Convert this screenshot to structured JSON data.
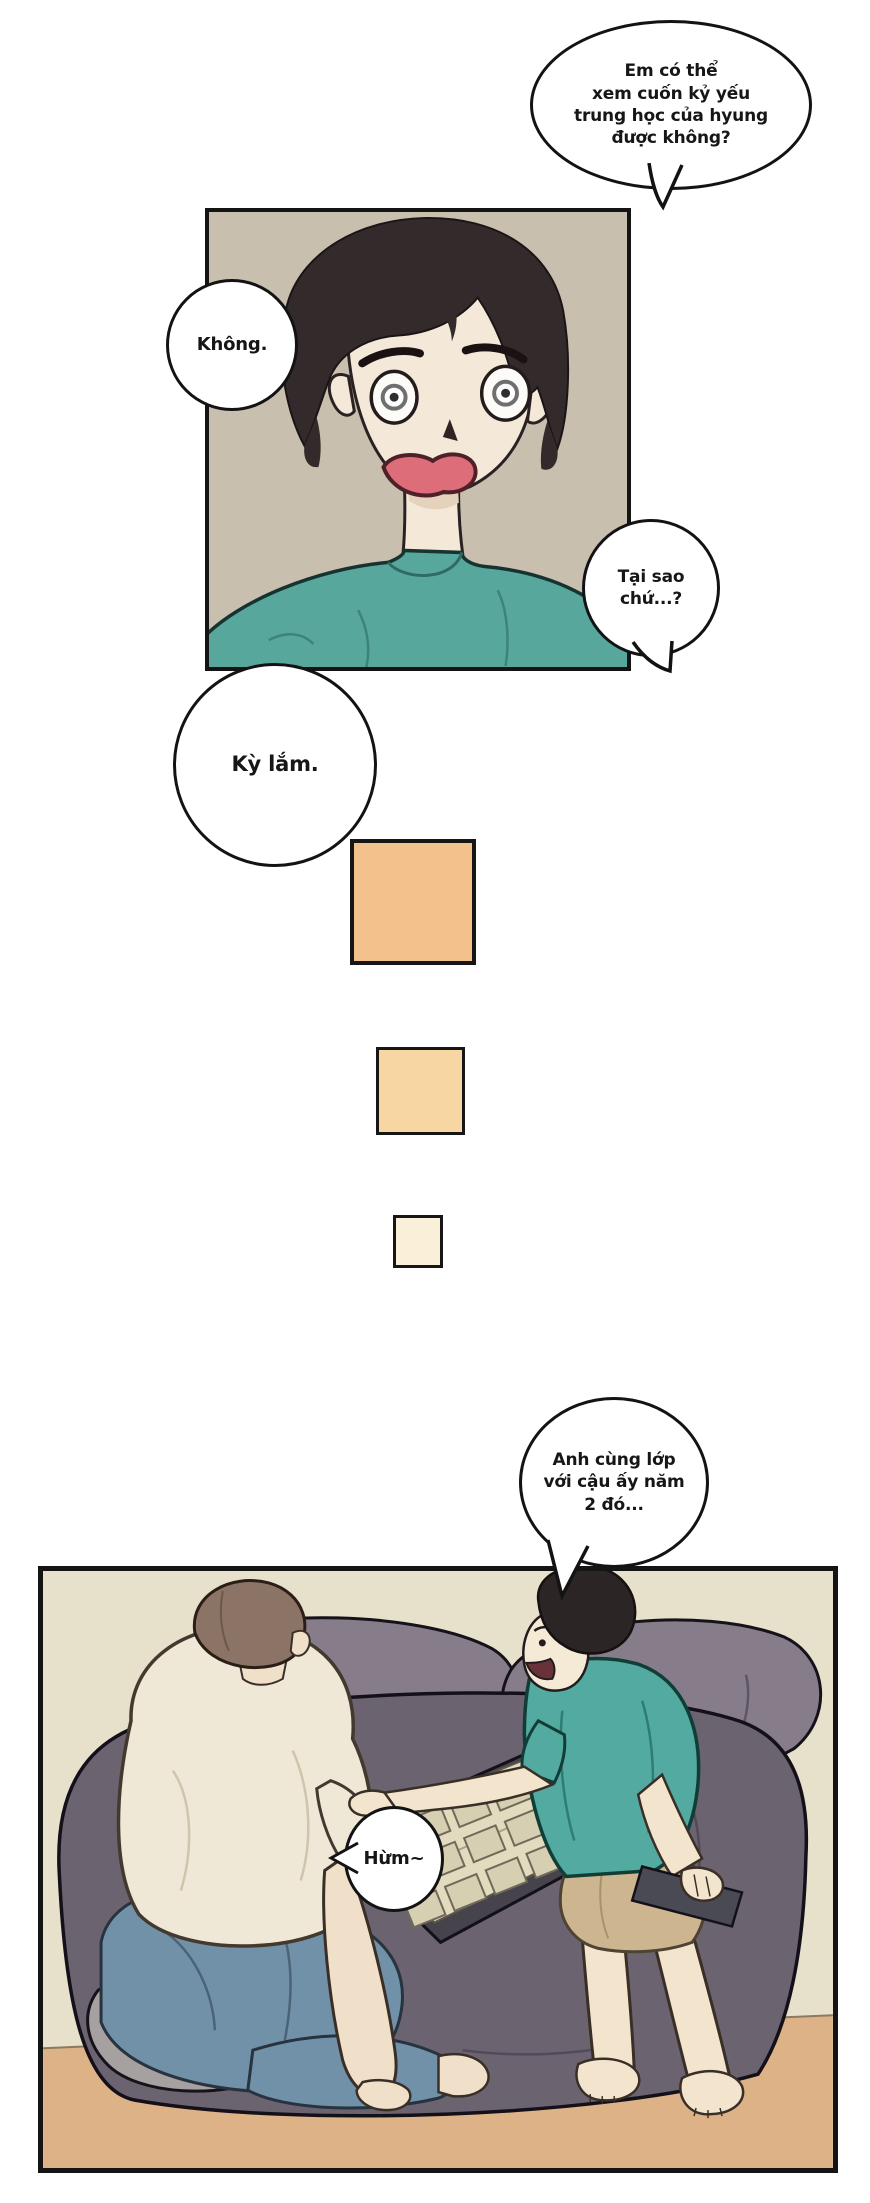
{
  "page": {
    "width": 870,
    "height": 2203,
    "background": "#ffffff"
  },
  "speech_bubbles": [
    {
      "id": "yearbook-request",
      "lines": [
        "Em có thể",
        "xem cuốn kỷ yếu",
        "trung học của hyung",
        "được không?"
      ]
    },
    {
      "id": "refusal",
      "lines": [
        "Không."
      ]
    },
    {
      "id": "why",
      "lines": [
        "Tại sao",
        "chứ...?"
      ]
    },
    {
      "id": "weird",
      "lines": [
        "Kỳ lắm."
      ]
    },
    {
      "id": "classmate",
      "lines": [
        "Anh cùng lớp",
        "với cậu ấy năm",
        "2 đó..."
      ]
    },
    {
      "id": "hum",
      "lines": [
        "Hừm~"
      ]
    }
  ],
  "transition_squares": [
    {
      "color": "#f2c18c"
    },
    {
      "color": "#f7d6a4"
    },
    {
      "color": "#faf0d9"
    }
  ],
  "colors": {
    "panel_border": "#141414",
    "bubble_border": "#131313",
    "panel1_background": "#c8bfae",
    "teal_shirt": "#58a79c",
    "hair_black": "#332a2b",
    "skin_light": "#f4e8d8",
    "mouth_red": "#dd6d79",
    "panel2_wall": "#e7e0cb",
    "panel2_floor": "#ddb287",
    "mattress": "#6c6370",
    "pillow": "#877d8a",
    "light_blanket": "#a7a0a0",
    "yearbook_pages": "#e3dbbd",
    "cream_shirt": "#efe8d6",
    "jeans_blue": "#7191a9",
    "brown_hair": "#8b7366",
    "shorts_khaki": "#cdb590",
    "phone_dark": "#4a4a55"
  }
}
